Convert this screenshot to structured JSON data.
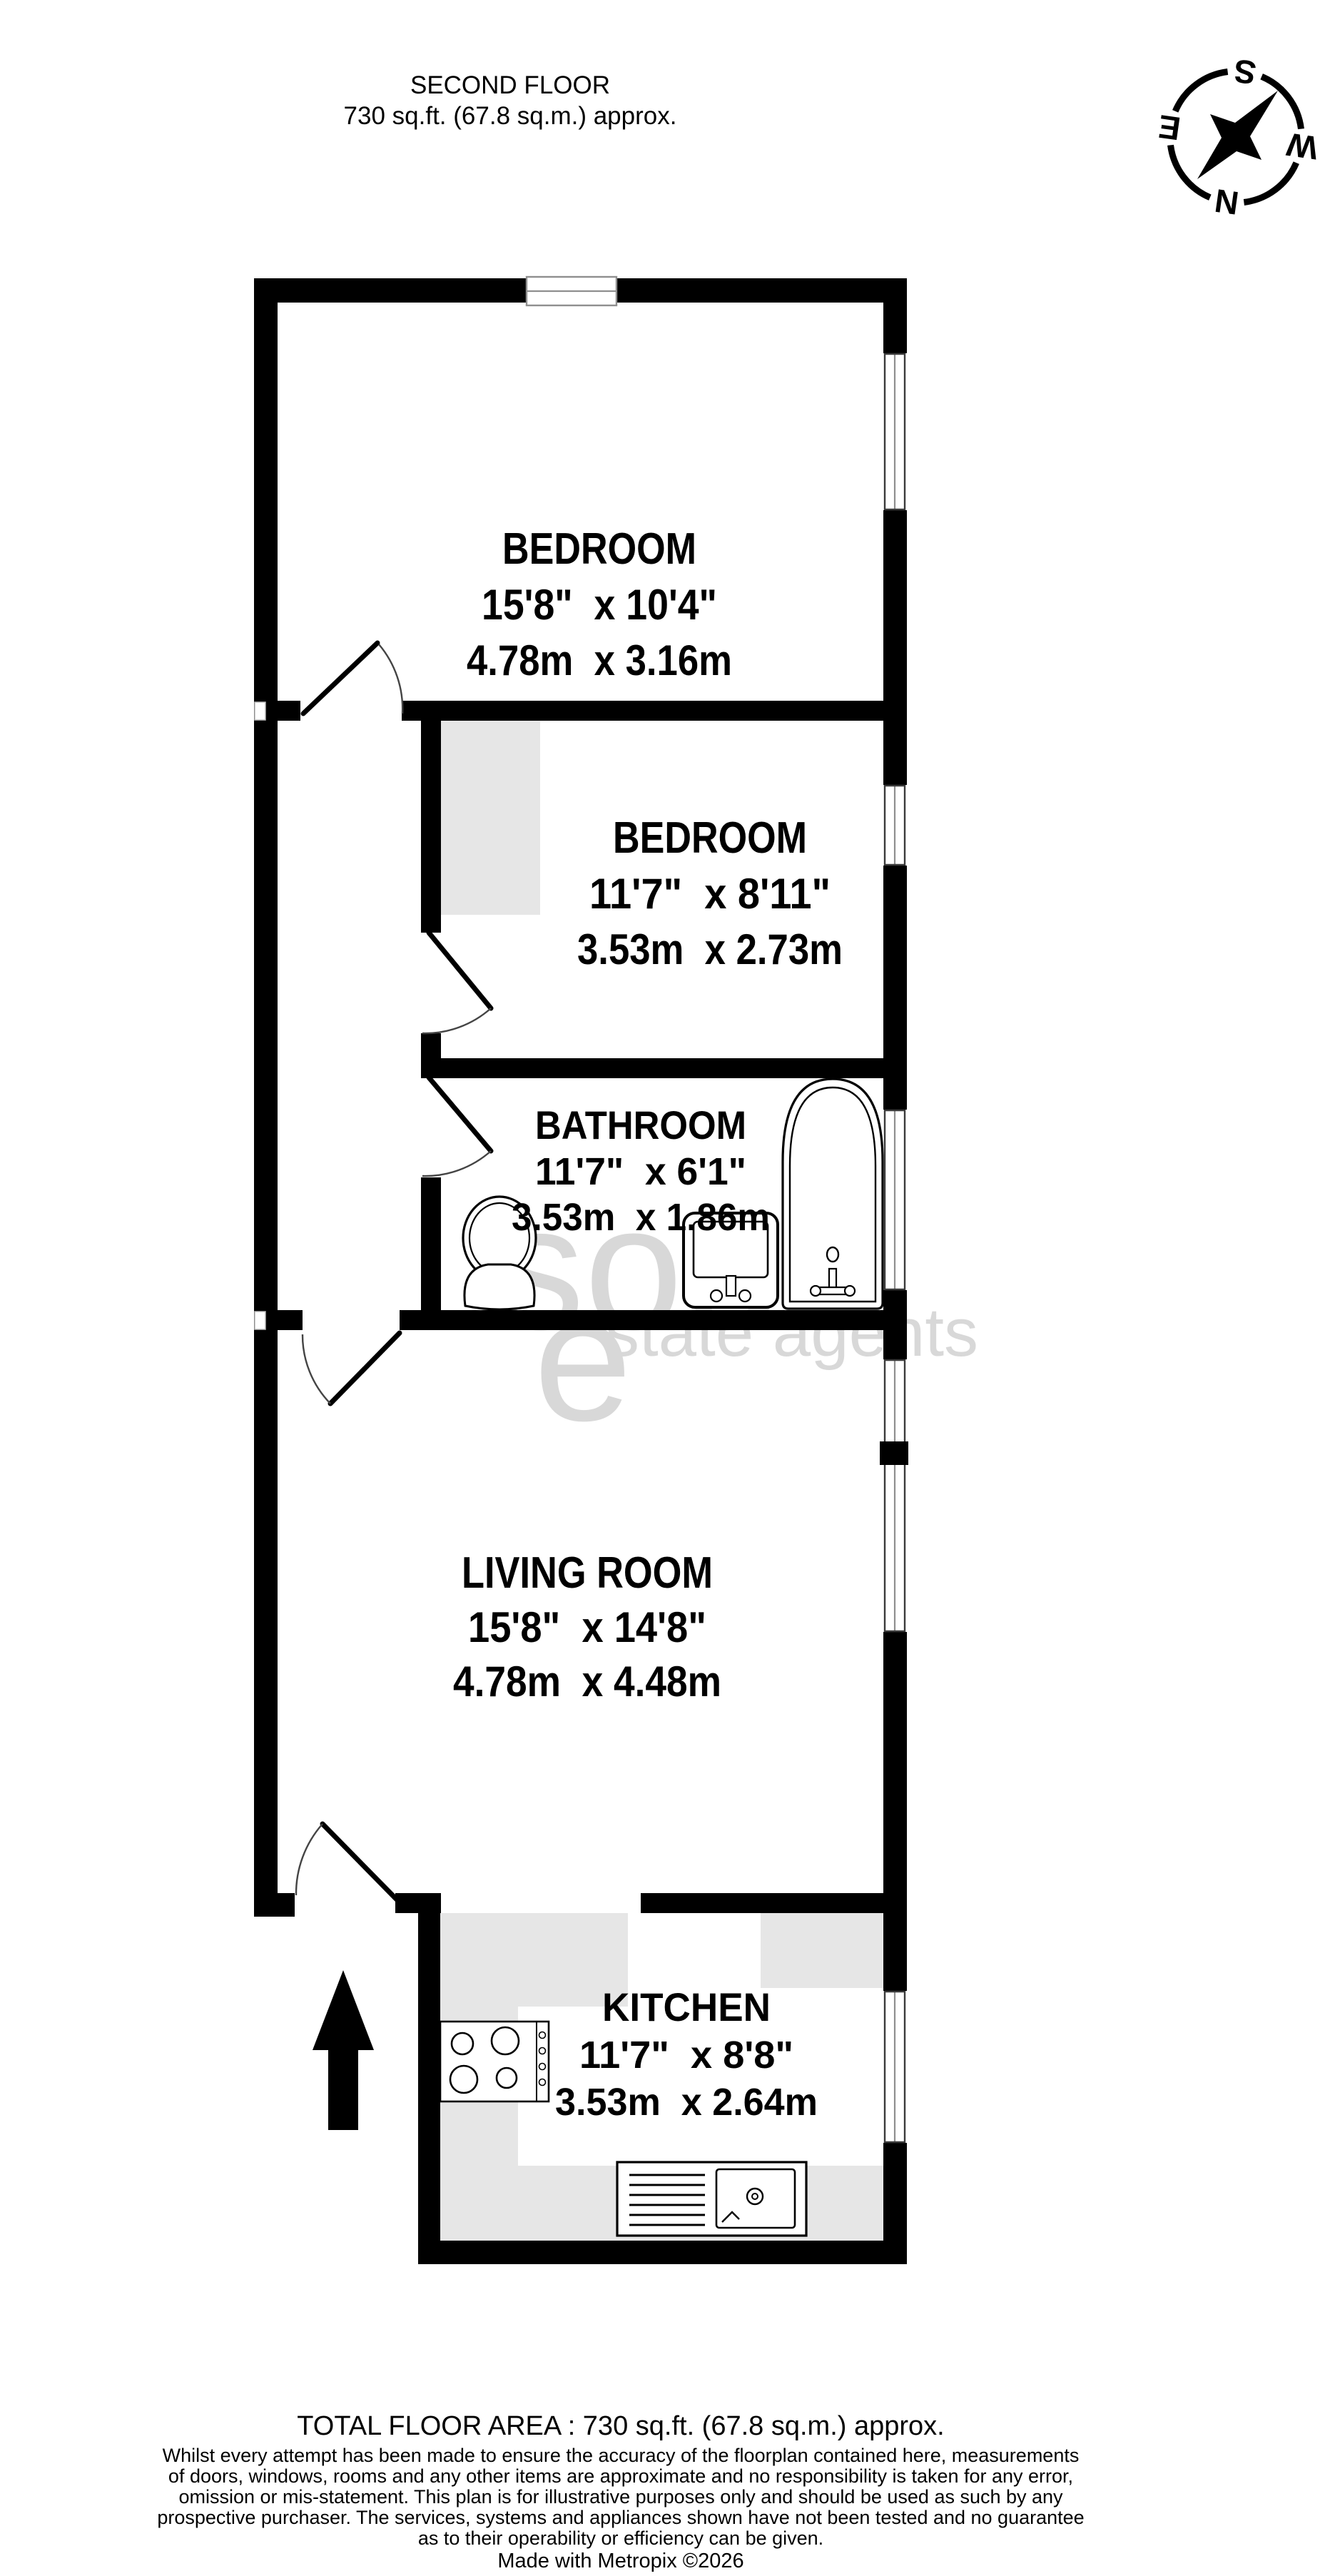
{
  "header": {
    "title": "SECOND FLOOR",
    "subtitle": "730 sq.ft. (67.8 sq.m.) approx."
  },
  "compass": {
    "n": "N",
    "e": "E",
    "s": "S",
    "w": "W"
  },
  "rooms": {
    "bedroom1": {
      "name": "BEDROOM",
      "imperial": "15'8\"  x 10'4\"",
      "metric": "4.78m  x 3.16m"
    },
    "bedroom2": {
      "name": "BEDROOM",
      "imperial": "11'7\"  x 8'11\"",
      "metric": "3.53m  x 2.73m"
    },
    "bathroom": {
      "name": "BATHROOM",
      "imperial": "11'7\"  x 6'1\"",
      "metric": "3.53m  x 1.86m"
    },
    "living": {
      "name": "LIVING ROOM",
      "imperial": "15'8\"  x 14'8\"",
      "metric": "4.78m  x 4.48m"
    },
    "kitchen": {
      "name": "KITCHEN",
      "imperial": "11'7\"  x 8'8\"",
      "metric": "3.53m  x 2.64m"
    }
  },
  "watermark": {
    "big": "sou",
    "e": "e",
    "small": "state agents"
  },
  "footer": {
    "total": "TOTAL FLOOR AREA : 730 sq.ft. (67.8 sq.m.) approx.",
    "disclaimer_lines": [
      "Whilst every attempt has been made to ensure the accuracy of the floorplan contained here, measurements",
      "of doors, windows, rooms and any other items are approximate and no responsibility is taken for any error,",
      "omission or mis-statement. This plan is for illustrative purposes only and should be used as such by any",
      "prospective purchaser. The services, systems and appliances shown have not been tested and no guarantee",
      "as to their operability or efficiency can be given."
    ],
    "credit": "Made with Metropix ©2026"
  },
  "colors": {
    "wall": "#000000",
    "counter": "#e6e6e6",
    "watermark": "#d8d8d8",
    "background": "#ffffff"
  }
}
